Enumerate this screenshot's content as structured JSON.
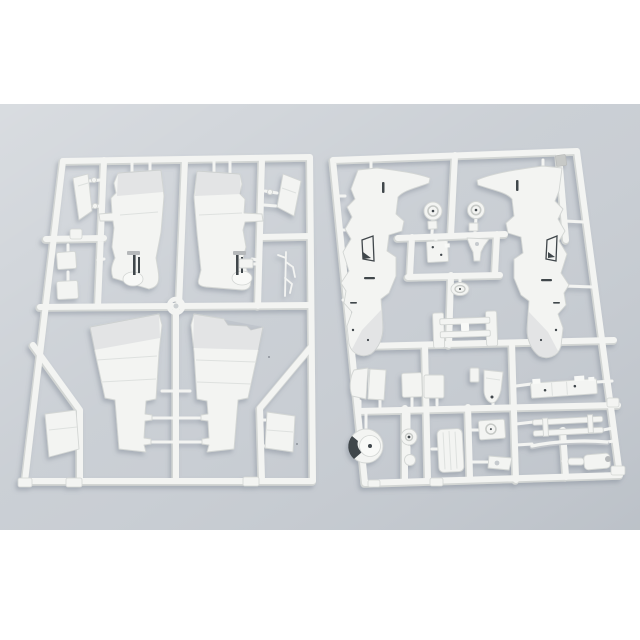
{
  "scene": {
    "kind": "product-photo",
    "subject": "two white injection-molded plastic model kit sprues (aircraft parts) lying on a pale blue-gray surface",
    "visible_text": "none"
  },
  "colors": {
    "page_bg": "#ffffff",
    "photo_bg": "#c8cdd3",
    "plastic": "#f3f4f2",
    "plastic_hi": "#f8f9f7",
    "plastic_edge": "#d3d6d4",
    "detail_dark": "#41464b",
    "detail_gray": "#b5b8ba",
    "gate_tab": "#c7c9c7",
    "shadow": "#6f7988"
  },
  "sprues": {
    "left": {
      "label": "wing sprue",
      "parts": [
        "upper-wing-half-left",
        "upper-wing-half-right",
        "lower-wing-half-left",
        "lower-wing-half-right",
        "tailplane-left",
        "tailplane-right",
        "flap-left",
        "flap-right",
        "access-panel-upper",
        "access-panel-lower",
        "trim-tab",
        "antenna-mast",
        "ring-grommet"
      ]
    },
    "right": {
      "label": "fuselage sprue",
      "parts": [
        "fuselage-half-left",
        "fuselage-half-right",
        "wheel-hub-left",
        "wheel-hub-right",
        "avionics-plate",
        "nose-gear-fork",
        "instrument-dome",
        "engine-bearer-frame",
        "bay-door-pair",
        "gear-door-left",
        "gear-door-right",
        "stores-pylon",
        "cockpit-floor-plate",
        "canopy-bracket",
        "wing-spar-strip",
        "main-wheel",
        "hub-cap",
        "control-ball",
        "fuel-tank",
        "panel-with-ring",
        "wedge-bracket",
        "exhaust-assembly",
        "sprue-gate-tab"
      ]
    }
  }
}
